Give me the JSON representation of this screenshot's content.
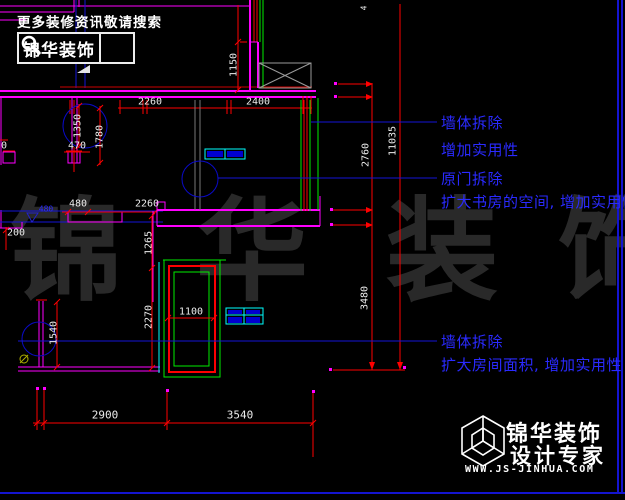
{
  "colors": {
    "wall_magenta": "#ff00ff",
    "dim_red": "#ff0000",
    "green": "#00ff00",
    "cyan": "#00ffff",
    "blue_line": "#1515d6",
    "annotation_blue": "#2a2aff",
    "watermark_gray": "#292929",
    "hatch_gray": "#9a9a9a",
    "yellow": "#b0b000",
    "white": "#ffffff"
  },
  "header": {
    "slogan": "更多装修资讯敬请搜索",
    "brand": "锦华装饰"
  },
  "watermark": {
    "char1": "锦",
    "char2": "华",
    "char3": "装",
    "char4": "饰"
  },
  "annotations": {
    "a1": {
      "line1": "墙体拆除",
      "line2": "增加实用性"
    },
    "a2": {
      "line1": "原门拆除",
      "line2": "扩大书房的空间, 增加实用性"
    },
    "a3": {
      "line1": "墙体拆除",
      "line2": "扩大房间面积, 增加实用性"
    }
  },
  "dims": {
    "top_left": "2260",
    "top_right": "2400",
    "top_vert": "1150",
    "top_cut": "4",
    "left_1350": "1350",
    "left_1780": "1780",
    "left_470": "470",
    "left_edge_0": "0",
    "mid_480": "480",
    "mid_2260": "2260",
    "left_200": "200",
    "elev_480": "480",
    "mid_1265": "1265",
    "mid_2270": "2270",
    "mid_1100": "1100",
    "left_1540": "1540",
    "right_2760": "2760",
    "right_11035": "11035",
    "right_3480": "3480",
    "bottom_2900": "2900",
    "bottom_3540": "3540"
  },
  "footer": {
    "brand": "锦华装饰",
    "subtitle": "设计专家",
    "url": "WWW.JS-JINHUA.COM"
  }
}
